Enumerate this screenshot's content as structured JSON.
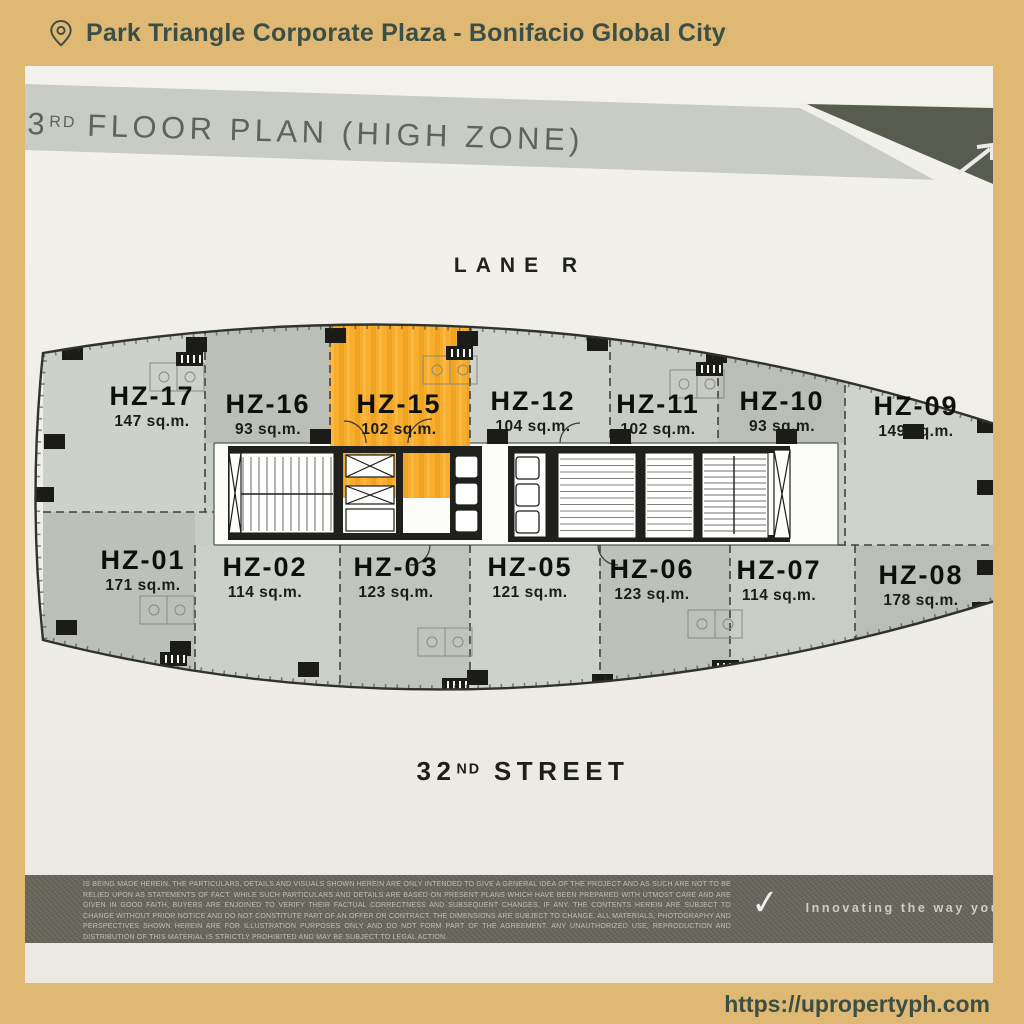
{
  "header": {
    "title": "Park Triangle Corporate Plaza - Bonifacio Global City"
  },
  "floor_plan": {
    "title": {
      "number": "3",
      "ordinal": "RD",
      "rest": "FLOOR PLAN (HIGH ZONE)"
    },
    "lane_label": "LANE R",
    "street_label": {
      "number": "32",
      "ordinal": "ND",
      "rest": "STREET"
    },
    "highlighted_unit": "HZ-15",
    "units_top": [
      {
        "id": "HZ-17",
        "area": "147 sq.m.",
        "highlighted": false
      },
      {
        "id": "HZ-16",
        "area": "93 sq.m.",
        "highlighted": false
      },
      {
        "id": "HZ-15",
        "area": "102 sq.m.",
        "highlighted": true
      },
      {
        "id": "HZ-12",
        "area": "104 sq.m.",
        "highlighted": false
      },
      {
        "id": "HZ-11",
        "area": "102 sq.m.",
        "highlighted": false
      },
      {
        "id": "HZ-10",
        "area": "93 sq.m.",
        "highlighted": false
      },
      {
        "id": "HZ-09",
        "area": "149 sq.m.",
        "highlighted": false
      }
    ],
    "units_bottom": [
      {
        "id": "HZ-01",
        "area": "171 sq.m.",
        "highlighted": false
      },
      {
        "id": "HZ-02",
        "area": "114 sq.m.",
        "highlighted": false
      },
      {
        "id": "HZ-03",
        "area": "123 sq.m.",
        "highlighted": false
      },
      {
        "id": "HZ-05",
        "area": "121 sq.m.",
        "highlighted": false
      },
      {
        "id": "HZ-06",
        "area": "123 sq.m.",
        "highlighted": false
      },
      {
        "id": "HZ-07",
        "area": "114 sq.m.",
        "highlighted": false
      },
      {
        "id": "HZ-08",
        "area": "178 sq.m.",
        "highlighted": false
      }
    ],
    "colors": {
      "highlight": "#f7ad2e",
      "frame_tan": "#dfb973",
      "accent_text": "#3c4f46",
      "paper": "#f1efe9"
    }
  },
  "footer": {
    "disclaimer": "IS BEING MADE HEREIN. THE PARTICULARS, DETAILS AND VISUALS SHOWN HEREIN ARE ONLY INTENDED TO GIVE A GENERAL IDEA OF THE PROJECT AND AS SUCH ARE NOT TO BE RELIED UPON AS STATEMENTS OF FACT. WHILE SUCH PARTICULARS AND DETAILS ARE BASED ON PRESENT PLANS WHICH HAVE BEEN PREPARED WITH UTMOST CARE AND ARE GIVEN IN GOOD FAITH, BUYERS ARE ENJOINED TO VERIFY THEIR FACTUAL CORRECTNESS AND SUBSEQUENT CHANGES, IF ANY. THE CONTENTS HEREIN ARE SUBJECT TO CHANGE WITHOUT PRIOR NOTICE AND DO NOT CONSTITUTE PART OF AN OFFER OR CONTRACT. THE DIMENSIONS ARE SUBJECT TO CHANGE. ALL MATERIALS, PHOTOGRAPHY AND PERSPECTIVES SHOWN HEREIN ARE FOR ILLUSTRATION PURPOSES ONLY AND DO NOT FORM PART OF THE AGREEMENT. ANY UNAUTHORIZED USE, REPRODUCTION AND DISTRIBUTION OF THIS MATERIAL IS STRICTLY PROHIBITED AND MAY BE SUBJECT TO LEGAL ACTION.",
    "checkmark_icon": "✓",
    "tagline": "Innovating the way you"
  },
  "website_url": "https://upropertyph.com"
}
